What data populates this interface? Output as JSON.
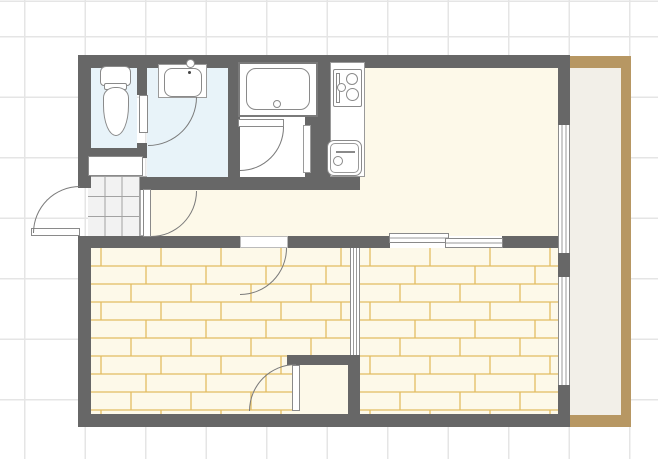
{
  "title": "apartment-floor-plan",
  "palette": {
    "wall": "#676767",
    "water_room_blue": "#e8f3f9",
    "cream_floor": "#fdf9e9",
    "wood_line": "#e3bd62",
    "white": "#ffffff",
    "fixture_border": "#8a8a8a",
    "door_arc": "#7a7a7a",
    "balcony_edge": "#b79763",
    "balcony_floor": "#f2efe8",
    "tile_bg": "#f2f2f2",
    "grid_line": "#e5e5e5"
  },
  "floorplan": {
    "shapes": [
      {
        "name": "balcony-edge-top",
        "type": "rect",
        "x": 570,
        "y": 56,
        "w": 61,
        "h": 12,
        "fill": "#b79763"
      },
      {
        "name": "balcony-edge-right",
        "type": "rect",
        "x": 621,
        "y": 56,
        "w": 10,
        "h": 371,
        "fill": "#b79763"
      },
      {
        "name": "balcony-edge-bottom",
        "type": "rect",
        "x": 570,
        "y": 415,
        "w": 61,
        "h": 12,
        "fill": "#b79763"
      },
      {
        "name": "balcony-floor",
        "type": "rect",
        "x": 570,
        "y": 68,
        "w": 51,
        "h": 347,
        "fill": "#f2efe8"
      },
      {
        "name": "room-living-dining-kitchen",
        "type": "rect",
        "x": 330,
        "y": 68,
        "w": 228,
        "h": 168,
        "fill": "#fdf9e9"
      },
      {
        "name": "room-hallway",
        "type": "rect",
        "x": 140,
        "y": 190,
        "w": 418,
        "h": 46,
        "fill": "#fdf9e9"
      },
      {
        "name": "room-toilet",
        "type": "rect",
        "x": 91,
        "y": 68,
        "w": 46,
        "h": 80,
        "fill": "#e8f3f9"
      },
      {
        "name": "room-washroom",
        "type": "rect",
        "x": 147,
        "y": 68,
        "w": 81,
        "h": 109,
        "fill": "#e8f3f9"
      },
      {
        "name": "room-bathroom-floor",
        "type": "rect",
        "x": 238,
        "y": 68,
        "w": 80,
        "h": 109,
        "fill": "#ffffff"
      },
      {
        "name": "entrance-tile-floor",
        "type": "tile",
        "x": 88,
        "y": 176,
        "w": 52,
        "h": 60
      },
      {
        "name": "entrance-step-edge",
        "type": "rect",
        "x": 140,
        "y": 176,
        "w": 7,
        "h": 60,
        "fill": "#ffffff",
        "border": "1px solid #aaaaaa"
      },
      {
        "name": "room-bedroom-left-wood-floor",
        "type": "wood",
        "x": 91,
        "y": 248,
        "w": 259,
        "h": 166,
        "fill": "#fdf9e9"
      },
      {
        "name": "room-bedroom-right-wood-floor",
        "type": "wood",
        "x": 360,
        "y": 248,
        "w": 198,
        "h": 166,
        "fill": "#fdf9e9"
      },
      {
        "name": "closet-floor",
        "type": "rect",
        "x": 300,
        "y": 365,
        "w": 48,
        "h": 49,
        "fill": "#fdf9e9"
      },
      {
        "name": "wall-outer-top",
        "type": "rect",
        "x": 78,
        "y": 55,
        "w": 492,
        "h": 13,
        "fill": "#676767"
      },
      {
        "name": "wall-outer-left-upper",
        "type": "rect",
        "x": 78,
        "y": 55,
        "w": 13,
        "h": 133,
        "fill": "#676767"
      },
      {
        "name": "wall-outer-left-lower",
        "type": "rect",
        "x": 78,
        "y": 236,
        "w": 13,
        "h": 191,
        "fill": "#676767"
      },
      {
        "name": "wall-outer-bottom",
        "type": "rect",
        "x": 78,
        "y": 414,
        "w": 492,
        "h": 13,
        "fill": "#676767"
      },
      {
        "name": "wall-outer-right-upper",
        "type": "rect",
        "x": 558,
        "y": 68,
        "w": 12,
        "h": 57,
        "fill": "#676767"
      },
      {
        "name": "wall-outer-right-middle",
        "type": "rect",
        "x": 558,
        "y": 253,
        "w": 12,
        "h": 24,
        "fill": "#676767"
      },
      {
        "name": "wall-outer-right-lower",
        "type": "rect",
        "x": 558,
        "y": 385,
        "w": 12,
        "h": 29,
        "fill": "#676767"
      },
      {
        "name": "wall-toilet-right-upper",
        "type": "rect",
        "x": 137,
        "y": 68,
        "w": 10,
        "h": 27,
        "fill": "#676767"
      },
      {
        "name": "wall-toilet-right-lower",
        "type": "rect",
        "x": 137,
        "y": 143,
        "w": 10,
        "h": 15,
        "fill": "#676767"
      },
      {
        "name": "wall-toilet-bottom",
        "type": "rect",
        "x": 78,
        "y": 148,
        "w": 69,
        "h": 10,
        "fill": "#676767"
      },
      {
        "name": "wall-washroom-bathroom",
        "type": "rect",
        "x": 228,
        "y": 68,
        "w": 12,
        "h": 109,
        "fill": "#676767"
      },
      {
        "name": "wall-bathroom-right",
        "type": "rect",
        "x": 305,
        "y": 113,
        "w": 13,
        "h": 64,
        "fill": "#676767"
      },
      {
        "name": "wall-kitchen-left",
        "type": "rect",
        "x": 318,
        "y": 68,
        "w": 12,
        "h": 122,
        "fill": "#676767"
      },
      {
        "name": "wall-middle-horizontal",
        "type": "rect",
        "x": 140,
        "y": 177,
        "w": 220,
        "h": 13,
        "fill": "#676767"
      },
      {
        "name": "wall-hall-bedroom-left",
        "type": "rect",
        "x": 91,
        "y": 236,
        "w": 149,
        "h": 12,
        "fill": "#676767"
      },
      {
        "name": "wall-hall-bedroom-middle",
        "type": "rect",
        "x": 288,
        "y": 236,
        "w": 102,
        "h": 12,
        "fill": "#676767"
      },
      {
        "name": "wall-hall-bedroom-right",
        "type": "rect",
        "x": 502,
        "y": 236,
        "w": 56,
        "h": 12,
        "fill": "#676767"
      },
      {
        "name": "wall-closet-top",
        "type": "rect",
        "x": 287,
        "y": 355,
        "w": 73,
        "h": 10,
        "fill": "#676767"
      },
      {
        "name": "wall-closet-right",
        "type": "rect",
        "x": 348,
        "y": 365,
        "w": 12,
        "h": 49,
        "fill": "#676767"
      },
      {
        "name": "sliding-partition-bedrooms",
        "type": "window_v",
        "x": 350,
        "y": 248,
        "w": 10,
        "h": 107,
        "fill": "#ffffff"
      },
      {
        "name": "window-living-right",
        "type": "window_v",
        "x": 558,
        "y": 125,
        "w": 12,
        "h": 128,
        "fill": "#ffffff"
      },
      {
        "name": "window-bedroom-right",
        "type": "window_v",
        "x": 558,
        "y": 277,
        "w": 12,
        "h": 108,
        "fill": "#ffffff"
      },
      {
        "name": "window-bedroom-top-panel-left",
        "type": "window_h",
        "x": 389,
        "y": 233,
        "w": 60,
        "h": 10,
        "fill": "#ffffff"
      },
      {
        "name": "window-bedroom-top-panel-right",
        "type": "window_h",
        "x": 445,
        "y": 238,
        "w": 58,
        "h": 10,
        "fill": "#ffffff"
      },
      {
        "name": "shoe-cabinet",
        "type": "rect",
        "x": 88,
        "y": 156,
        "w": 55,
        "h": 20,
        "fill": "#ffffff",
        "border": "1.5px solid #8a8a8a"
      },
      {
        "name": "toilet-tank",
        "type": "rect",
        "x": 100,
        "y": 66,
        "w": 31,
        "h": 20,
        "fill": "#ffffff",
        "border": "1.5px solid #8a8a8a",
        "radius": "6px 6px 4px 4px"
      },
      {
        "name": "toilet-seat-joint",
        "type": "rect",
        "x": 104,
        "y": 83,
        "w": 23,
        "h": 7,
        "fill": "#ffffff",
        "border": "1.5px solid #8a8a8a",
        "radius": "2px"
      },
      {
        "name": "toilet-bowl",
        "type": "rect",
        "x": 103,
        "y": 87,
        "w": 26,
        "h": 49,
        "fill": "#ffffff",
        "border": "1.5px solid #8a8a8a",
        "radius": "45% 45% 50% 50% / 22% 22% 62% 62%"
      },
      {
        "name": "washbasin-counter",
        "type": "rect",
        "x": 158,
        "y": 64,
        "w": 49,
        "h": 34,
        "fill": "#ffffff",
        "border": "1px solid #9a9a9a"
      },
      {
        "name": "washbasin-bowl",
        "type": "rect",
        "x": 164,
        "y": 68,
        "w": 38,
        "h": 29,
        "fill": "#ffffff",
        "border": "1.2px solid #8a8a8a",
        "radius": "8px"
      },
      {
        "name": "washbasin-faucet",
        "type": "circle",
        "x": 186,
        "y": 59,
        "w": 9,
        "h": 9,
        "fill": "#ffffff",
        "border": "1.2px solid #8a8a8a"
      },
      {
        "name": "washbasin-drain-dot",
        "type": "circle",
        "x": 188,
        "y": 71,
        "w": 3,
        "h": 3,
        "fill": "#444444"
      },
      {
        "name": "bathtub-outer",
        "type": "rect",
        "x": 238,
        "y": 62,
        "w": 80,
        "h": 55,
        "fill": "#ffffff",
        "border": "2px solid #7a7a7a"
      },
      {
        "name": "bathtub-inner",
        "type": "rect",
        "x": 246,
        "y": 68,
        "w": 64,
        "h": 42,
        "fill": "#ffffff",
        "border": "1.2px solid #8a8a8a",
        "radius": "10px"
      },
      {
        "name": "bathtub-drain",
        "type": "circle",
        "x": 273,
        "y": 100,
        "w": 8,
        "h": 8,
        "fill": "#ffffff",
        "border": "1.2px solid #8a8a8a"
      },
      {
        "name": "kitchen-counter",
        "type": "rect",
        "x": 330,
        "y": 62,
        "w": 35,
        "h": 115,
        "fill": "#ffffff",
        "border": "1px solid #9a9a9a"
      },
      {
        "name": "stove-top",
        "type": "rect",
        "x": 333,
        "y": 69,
        "w": 29,
        "h": 38,
        "fill": "#ffffff",
        "border": "1.2px solid #8a8a8a",
        "radius": "2px"
      },
      {
        "name": "stove-grill",
        "type": "rect",
        "x": 336,
        "y": 73,
        "w": 4,
        "h": 30,
        "fill": "#ffffff",
        "border": "1px solid #8a8a8a"
      },
      {
        "name": "stove-burner-top",
        "type": "circle",
        "x": 346,
        "y": 73,
        "w": 12,
        "h": 12,
        "fill": "#ffffff",
        "border": "1.2px solid #8a8a8a"
      },
      {
        "name": "stove-burner-bottom",
        "type": "circle",
        "x": 346,
        "y": 88,
        "w": 13,
        "h": 13,
        "fill": "#ffffff",
        "border": "1.2px solid #8a8a8a"
      },
      {
        "name": "stove-burner-small",
        "type": "circle",
        "x": 337,
        "y": 83,
        "w": 9,
        "h": 9,
        "fill": "#ffffff",
        "border": "1.2px solid #8a8a8a"
      },
      {
        "name": "kitchen-sink",
        "type": "rect",
        "x": 327,
        "y": 140,
        "w": 35,
        "h": 36,
        "fill": "#ffffff",
        "border": "1.2px solid #8a8a8a",
        "radius": "7px"
      },
      {
        "name": "kitchen-sink-inner",
        "type": "rect",
        "x": 330,
        "y": 143,
        "w": 29,
        "h": 30,
        "fill": "#ffffff",
        "border": "1px solid #9a9a9a",
        "radius": "5px"
      },
      {
        "name": "kitchen-sink-faucet-arm",
        "type": "rect",
        "x": 336,
        "y": 151,
        "w": 19,
        "h": 2,
        "fill": "#8a8a8a"
      },
      {
        "name": "kitchen-sink-faucet",
        "type": "circle",
        "x": 333,
        "y": 156,
        "w": 10,
        "h": 10,
        "fill": "#ffffff",
        "border": "1.2px solid #8a8a8a"
      },
      {
        "name": "bathroom-side-door-leaf",
        "type": "rect",
        "x": 303,
        "y": 125,
        "w": 8,
        "h": 48,
        "fill": "#ffffff",
        "border": "1px solid #9a9a9a"
      },
      {
        "name": "front-door-leaf",
        "type": "rect",
        "x": 31,
        "y": 228,
        "w": 49,
        "h": 8,
        "fill": "#ffffff",
        "border": "1px solid #8a8a8a"
      },
      {
        "name": "front-door-swing-arc",
        "type": "arc",
        "corner": "tl",
        "x": 33,
        "y": 186,
        "w": 47,
        "h": 47
      },
      {
        "name": "toilet-door-leaf",
        "type": "rect",
        "x": 139,
        "y": 95,
        "w": 9,
        "h": 38,
        "fill": "#ffffff",
        "border": "1px solid #8a8a8a"
      },
      {
        "name": "toilet-door-swing-arc",
        "type": "arc",
        "corner": "br",
        "x": 148,
        "y": 97,
        "w": 49,
        "h": 49
      },
      {
        "name": "entrance-hall-door-leaf",
        "type": "rect",
        "x": 143,
        "y": 189,
        "w": 8,
        "h": 48,
        "fill": "#ffffff",
        "border": "1px solid #8a8a8a"
      },
      {
        "name": "entrance-hall-door-swing-arc",
        "type": "arc",
        "corner": "br",
        "x": 151,
        "y": 191,
        "w": 46,
        "h": 46
      },
      {
        "name": "bathroom-door-leaf",
        "type": "rect",
        "x": 238,
        "y": 119,
        "w": 46,
        "h": 8,
        "fill": "#ffffff",
        "border": "1px solid #8a8a8a"
      },
      {
        "name": "bathroom-door-swing-arc",
        "type": "arc",
        "corner": "br",
        "x": 240,
        "y": 127,
        "w": 44,
        "h": 44
      },
      {
        "name": "bedroom-door-opening",
        "type": "rect",
        "x": 240,
        "y": 236,
        "w": 48,
        "h": 12,
        "fill": "#ffffff",
        "border": "1px solid #bbbbbb"
      },
      {
        "name": "bedroom-door-swing-arc",
        "type": "arc",
        "corner": "br",
        "x": 240,
        "y": 248,
        "w": 47,
        "h": 47
      },
      {
        "name": "closet-door-leaf",
        "type": "rect",
        "x": 292,
        "y": 365,
        "w": 8,
        "h": 46,
        "fill": "#ffffff",
        "border": "1px solid #8a8a8a"
      },
      {
        "name": "closet-door-swing-arc",
        "type": "arc",
        "corner": "tl",
        "x": 249,
        "y": 364,
        "w": 47,
        "h": 47
      }
    ]
  }
}
